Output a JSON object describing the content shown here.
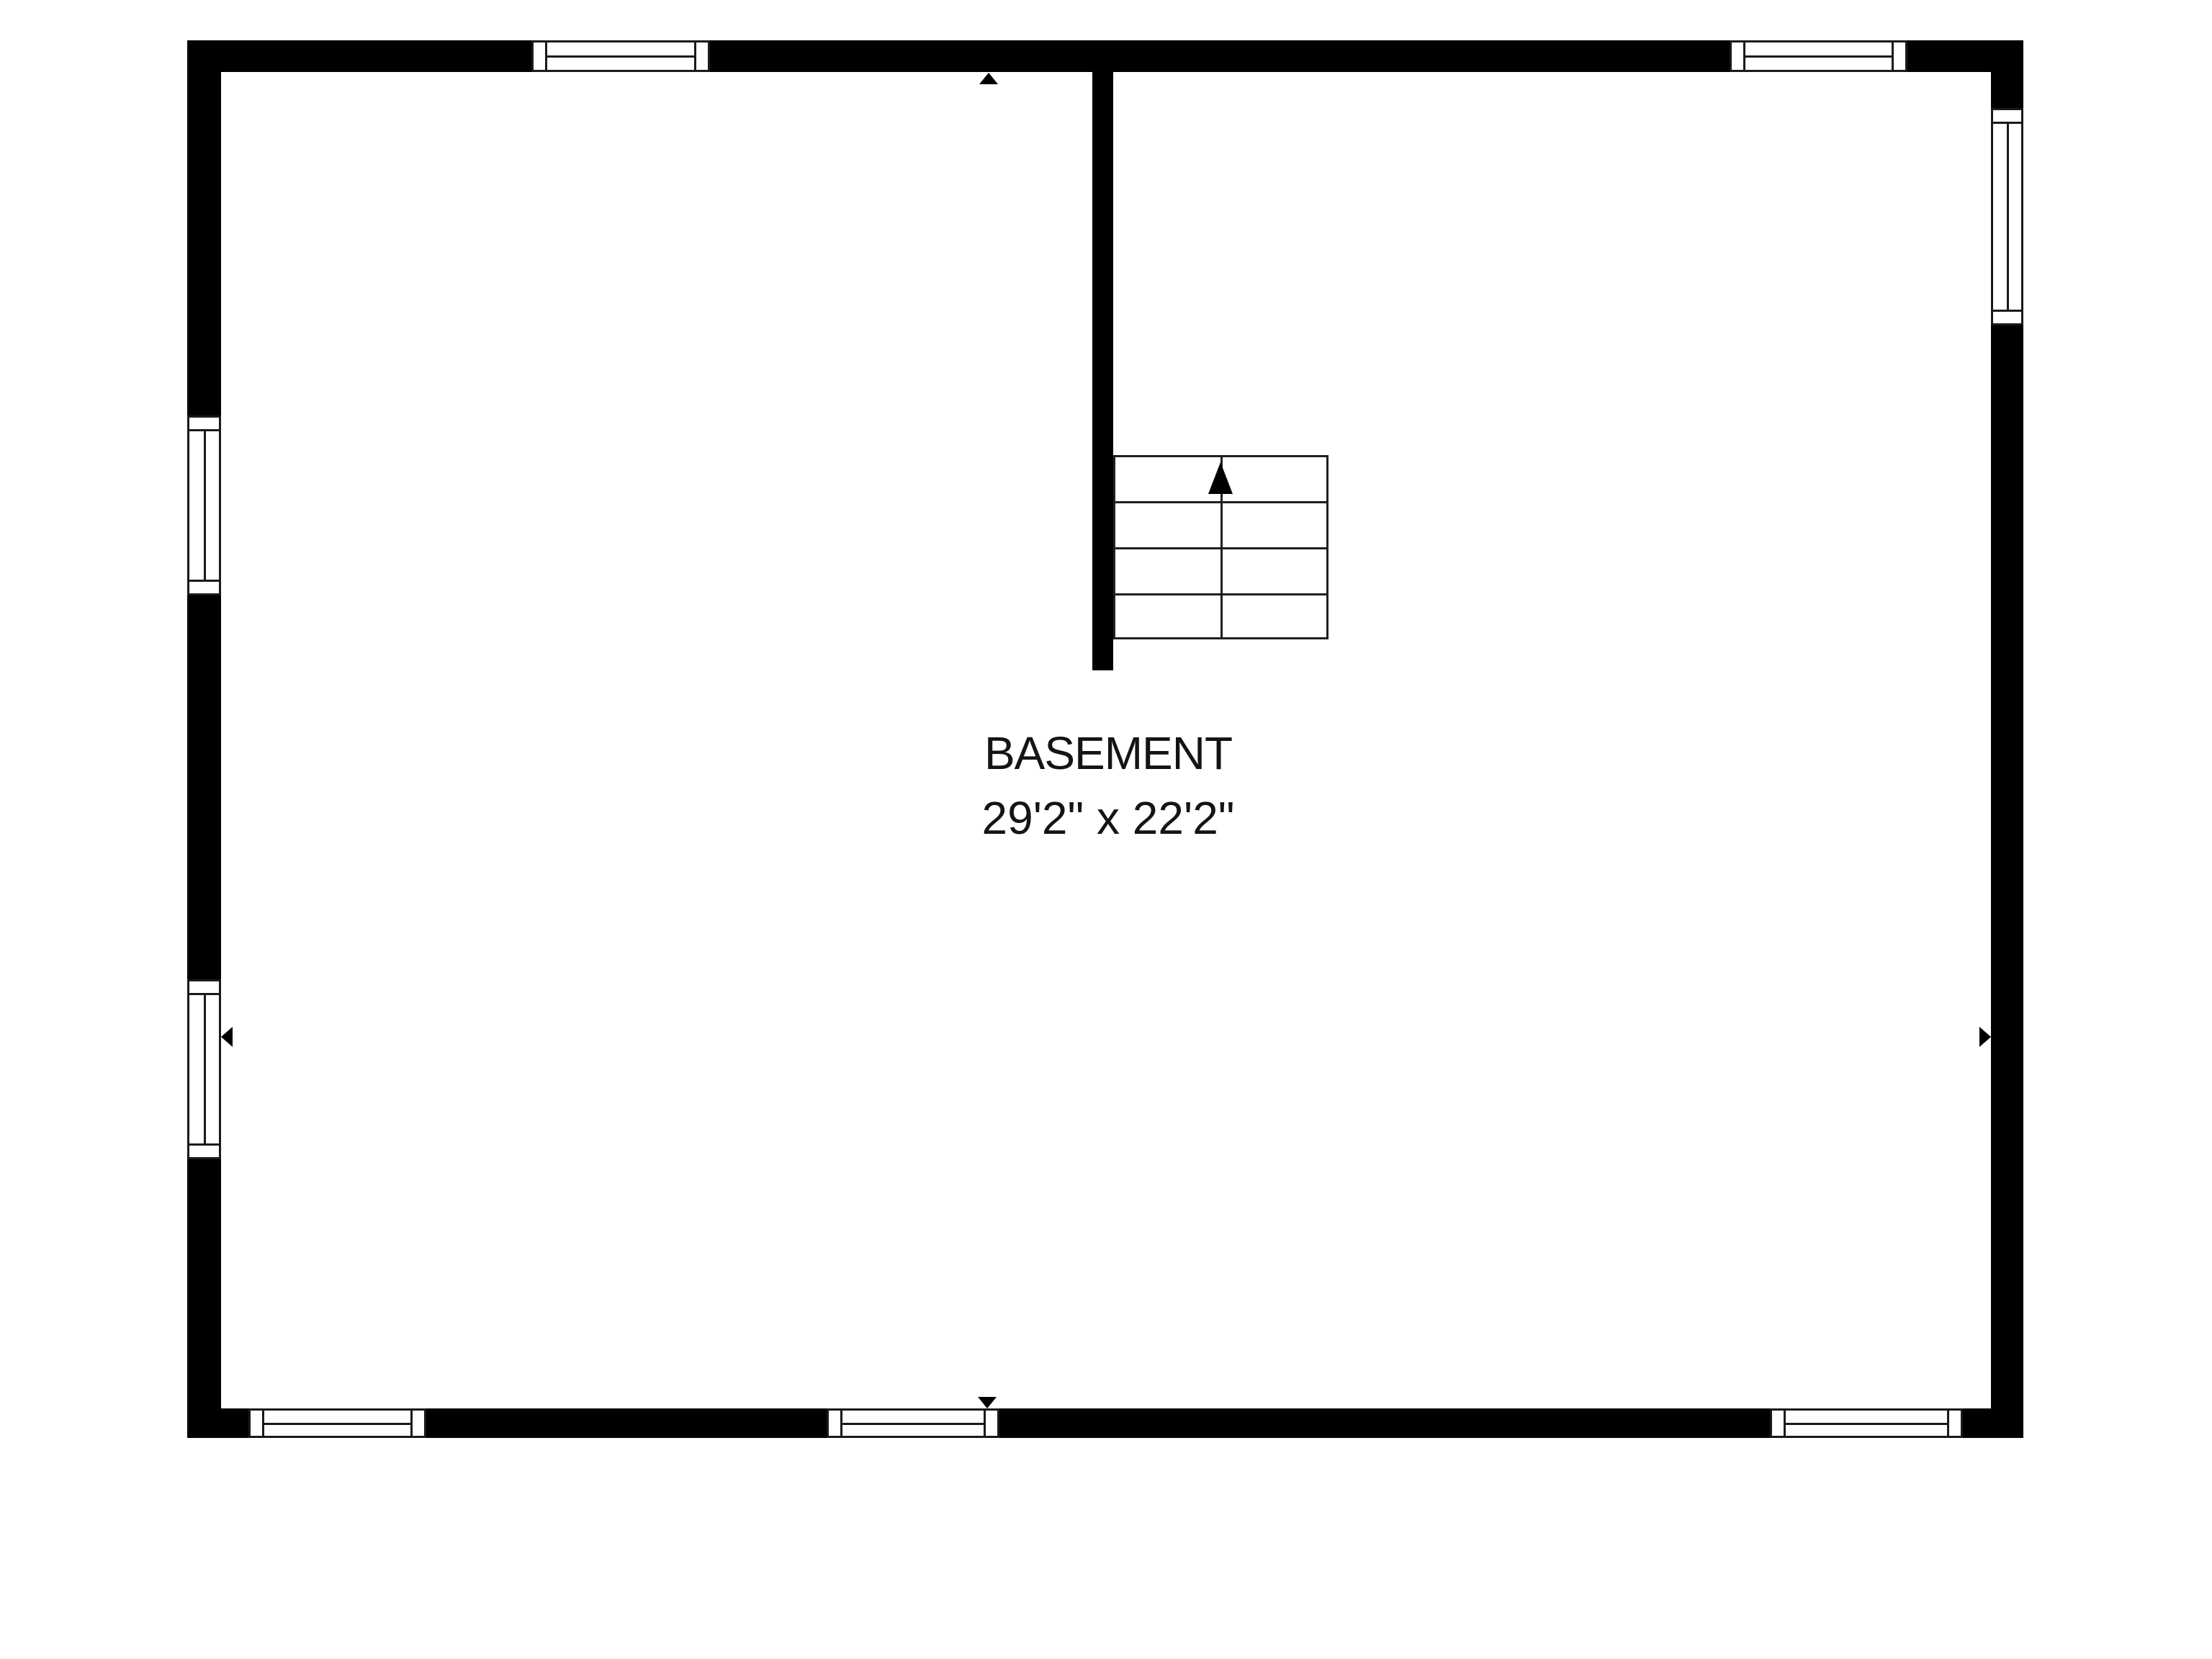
{
  "floorplan": {
    "room": {
      "label": "BASEMENT",
      "dimensions": "29'2\" x 22'2\""
    },
    "colors": {
      "wall": "#000000",
      "line": "#1f1f1f",
      "text": "#141414",
      "background": "#ffffff"
    },
    "symbols": {
      "stairs": {
        "name": "staircase",
        "steps": 4,
        "direction_icon": "up-arrow"
      },
      "windows": [
        "window-top-left",
        "window-top-right",
        "window-left-upper",
        "window-left-lower",
        "window-right-upper",
        "window-bottom-left",
        "window-bottom-center",
        "window-bottom-right"
      ],
      "entry_markers": [
        "up-arrow-marker-top-wall",
        "left-arrow-marker-left-wall",
        "right-arrow-marker-right-wall",
        "down-arrow-marker-bottom-wall"
      ]
    }
  }
}
